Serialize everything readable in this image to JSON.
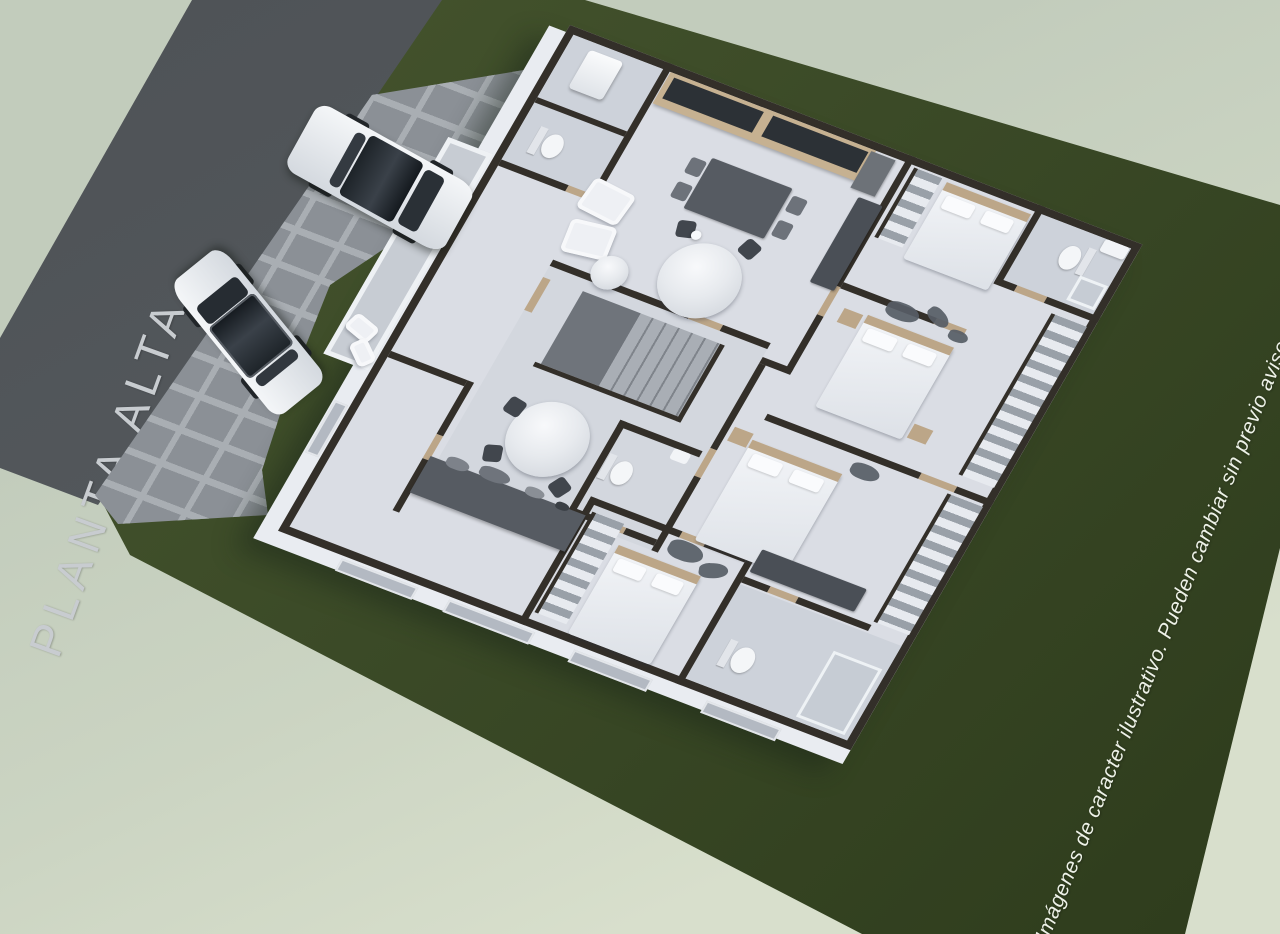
{
  "scene": {
    "labels": {
      "floor_title": "PLANTA ALTA",
      "disclaimer": "Imágenes de caracter ilustrativo. Pueden cambiar sin previo aviso"
    },
    "palette": {
      "background": "#c9d2c1",
      "lawn": "#3b4a27",
      "road": "#55595d",
      "road-text": "#c8ccd0",
      "driveway": "#8b9096",
      "paver-joint": "#a9aeb3",
      "wall": "#332f29",
      "wall-face": "#e9ecf1",
      "floor": "#dadde4",
      "floor-wet": "#cdd2da",
      "door": "#bca688",
      "furniture-dark": "#4a4f56",
      "furniture-light": "#eef0f4",
      "counter": "#565b62",
      "disclaimer-text": "#edf1e7"
    }
  }
}
